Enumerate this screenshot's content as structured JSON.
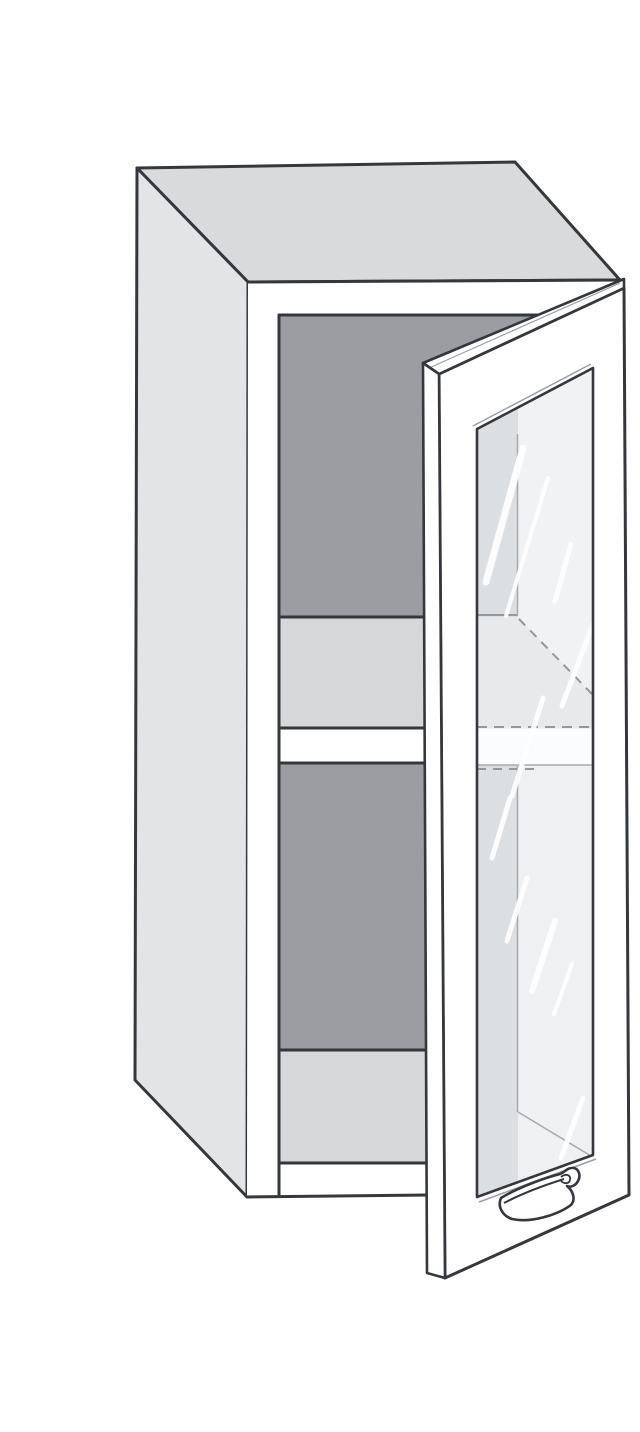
{
  "illustration": {
    "subject": "Wall cabinet with open glass door",
    "style": "catalog line drawing, three-quarter perspective",
    "door": "single glass door, hinged on right, shown open",
    "shelves_visible": 1,
    "handle": "curved bow handle at lower door edge"
  },
  "palette": {
    "background": "#ffffff",
    "outline": "#34373c",
    "outline_soft": "#9b9fa4",
    "top_face": "#d9dadc",
    "side_face": "#e3e4e6",
    "interior_dark": "#9b9da2",
    "shelf_light": "#d5d7d9",
    "white": "#ffffff",
    "glass_base": "#eef0f2",
    "glass_dark": "#dcdfe2",
    "glass_mid": "#e7e9eb",
    "glass_bright": "#f0f2f4",
    "glass_band": "#fbfcfd",
    "glass_line": "#a8acb0",
    "glass_dash": "#94989d",
    "streak": "#ffffff"
  }
}
